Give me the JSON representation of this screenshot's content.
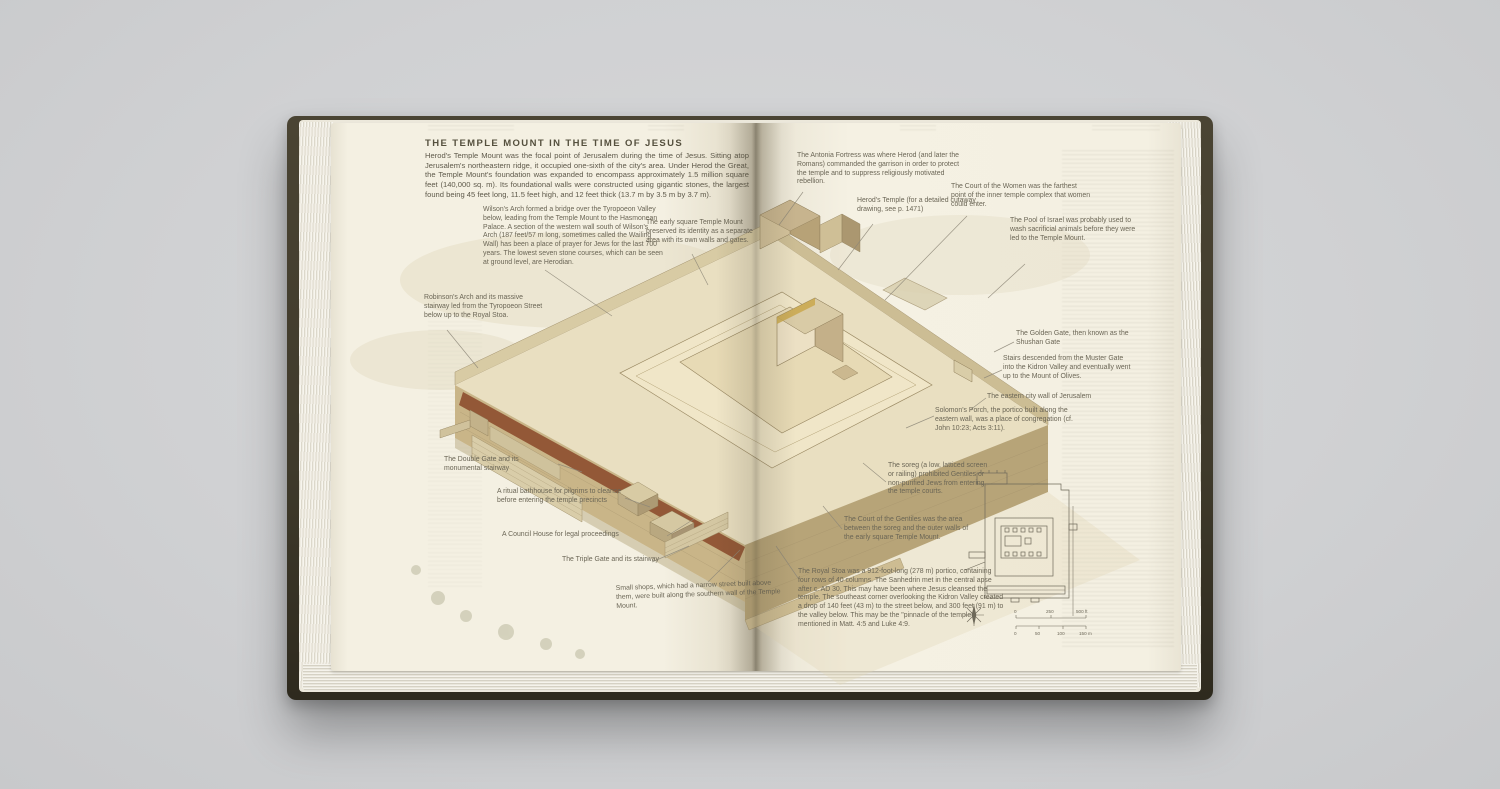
{
  "page": {
    "title": "THE TEMPLE MOUNT IN THE TIME OF JESUS",
    "intro": "Herod's Temple Mount was the focal point of Jerusalem during the time of Jesus. Sitting atop Jerusalem's northeastern ridge, it occupied one-sixth of the city's area. Under Herod the Great, the Temple Mount's foundation was expanded to encompass approximately 1.5 million square feet (140,000 sq. m). Its foundational walls were constructed using gigantic stones, the largest found being 45 feet long, 11.5 feet high, and 12 feet thick (13.7 m by 3.5 m by 3.7 m)."
  },
  "labels": {
    "wilsons_arch": "Wilson's Arch formed a bridge over the Tyropoeon Valley below, leading from the Temple Mount to the Hasmonean Palace. A section of the western wall south of Wilson's Arch (187 feet/57 m long, sometimes called the Wailing Wall) has been a place of prayer for Jews for the last 700 years. The lowest seven stone courses, which can be seen at ground level, are Herodian.",
    "early_square": "The early square Temple Mount preserved its identity as a separate area with its own walls and gates.",
    "robinsons_arch": "Robinson's Arch and its massive stairway led from the Tyropoeon Street below up to the Royal Stoa.",
    "double_gate": "The Double Gate and its monumental stairway",
    "bathhouse": "A ritual bathhouse for pilgrims to cleanse before entering the temple precincts",
    "council_house": "A Council House for legal proceedings",
    "triple_gate": "The Triple Gate and its stairway",
    "small_shops": "Small shops, which had a narrow street built above them, were built along the southern wall of the Temple Mount.",
    "antonia": "The Antonia Fortress was where Herod (and later the Romans) commanded the garrison in order to protect the temple and to suppress religiously motivated rebellion.",
    "herods_temple": "Herod's Temple (for a detailed cutaway drawing, see p. 1471)",
    "court_women": "The Court of the Women was the farthest point of the inner temple complex that women could enter.",
    "pool_israel": "The Pool of Israel was probably used to wash sacrificial animals before they were led to the Temple Mount.",
    "golden_gate": "The Golden Gate, then known as the Shushan Gate",
    "stairs_muster": "Stairs descended from the Muster Gate into the Kidron Valley and eventually went up to the Mount of Olives.",
    "eastern_wall": "The eastern city wall of Jerusalem",
    "solomons_porch": "Solomon's Porch, the portico built along the eastern wall, was a place of congregation (cf. John 10:23; Acts 3:11).",
    "soreg": "The soreg (a low, latticed screen or railing) prohibited Gentiles or non-purified Jews from entering the temple courts.",
    "court_gentiles": "The Court of the Gentiles was the area between the soreg and the outer walls of the early square Temple Mount.",
    "royal_stoa": "The Royal Stoa was a 912-foot-long (278 m) portico, containing four rows of 40 columns. The Sanhedrin met in the central apse after c. AD 30. This may have been where Jesus cleansed the temple. The southeast corner overlooking the Kidron Valley created a drop of 140 feet (43 m) to the street below, and 300 feet (91 m) to the valley below. This may be the \"pinnacle of the temple\" mentioned in Matt. 4:5 and Luke 4:9."
  },
  "plan": {
    "ft_ticks": [
      "0",
      "250",
      "500 ft"
    ],
    "m_ticks": [
      "0",
      "50",
      "100",
      "150 m"
    ]
  },
  "colors": {
    "background_gray": "#d0d1d3",
    "cover_olive": "#3f3a2b",
    "page_cream": "#f4f0e2",
    "stoa_roof_red": "#935837",
    "wall_tan": "#c9b588",
    "label_ink": "#6b6656"
  }
}
